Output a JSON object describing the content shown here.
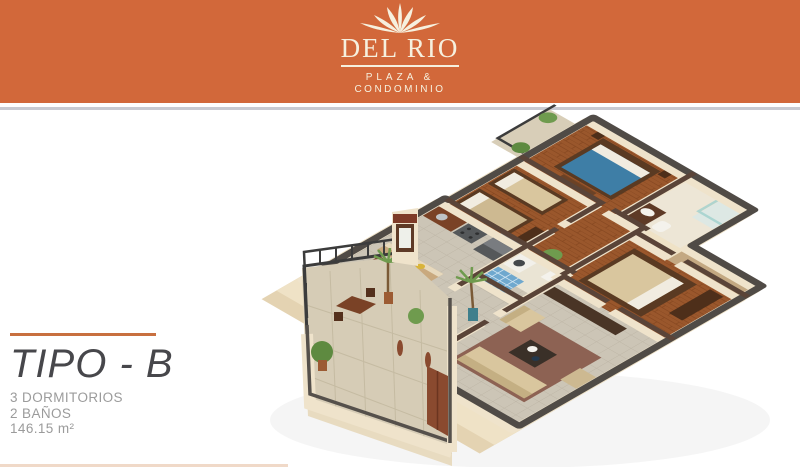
{
  "brand": {
    "name": "DEL RIO",
    "tagline_line1": "PLAZA &",
    "tagline_line2": "CONDOMINIO",
    "logo_icon": "palm-fountain-icon"
  },
  "plan": {
    "title": "TIPO - B",
    "spec_bedrooms": "3 DORMITORIOS",
    "spec_baths": "2 BAÑOS",
    "spec_area": "146.15 m²",
    "floorplan_description": "3D isometric cutaway floor plan of apartment type B"
  },
  "colors": {
    "header_orange": "#d2683a",
    "accent_rule_orange": "#c8703f",
    "logo_cream": "#f6f0de",
    "title_gray": "#47474b",
    "spec_gray": "#9b9b9b",
    "wall_cream": "#efe3cb",
    "wall_cap_dark": "#504b46",
    "interior_cap_brown": "#74422c",
    "wood_floor": "#9a572c",
    "tile_floor": "#ccc5b6",
    "bed_blue": "#3e7ea6",
    "sofa_beige": "#d9c69e",
    "rug_brown": "#8d6253",
    "plant_green": "#6f9b4e"
  }
}
